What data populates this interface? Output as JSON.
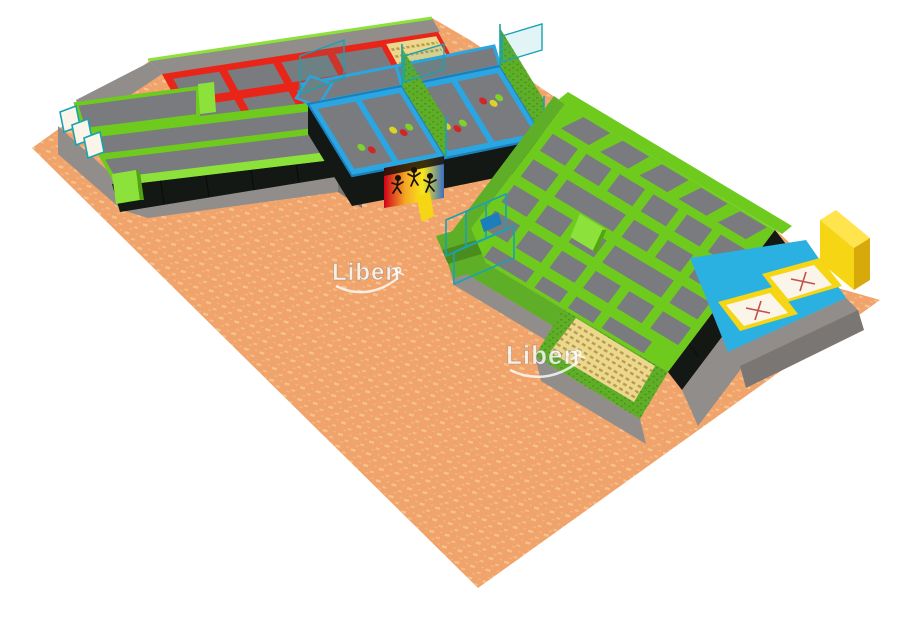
{
  "watermark": {
    "text": "Liben"
  },
  "scene": {
    "type": "3d-isometric-render",
    "subject": "indoor trampoline park layout",
    "floor": "orange speckled carpet",
    "zones": [
      "runway-lanes-left-wing",
      "angled-wall-trampoline",
      "red-trampoline-grid",
      "foam-block-pit-top",
      "dodgeball-court-1",
      "dodgeball-court-2",
      "grass-divider-walls",
      "graffiti-mural-panel",
      "slide",
      "basketball-hoop-frames",
      "grass-steps",
      "main-trampoline-court",
      "wedge-ramp",
      "foam-block-pit-bottom",
      "airbag-landing-zone"
    ]
  },
  "colors": {
    "bg": "#ffffff",
    "carpet": "#f0a36b",
    "carpet_speckle": "#f9d09a",
    "wall_gray": "#918d8a",
    "wall_gray_dark": "#7a7673",
    "wall_gray_light": "#a39f9b",
    "pad_black": "#141814",
    "pad_line": "#000000",
    "frame_green": "#6ecb1e",
    "frame_green_dark": "#51a511",
    "frame_green_light": "#8ce23a",
    "frame_red": "#e92519",
    "frame_blue": "#2aa6e2",
    "frame_blue_dark": "#1d7fba",
    "mat_gray": "#797b7e",
    "mat_gray_dark": "#626468",
    "grass": "#5fae28",
    "grass_dark": "#4a8d1d",
    "glass_teal": "#18a2b4",
    "foam_tan": "#ecd88c",
    "foam_tan_dark": "#b99c50",
    "yellow": "#f6d514",
    "yellow_dark": "#d8a90b",
    "yellow_light": "#ffe44d",
    "airbag_white": "#faf5e8",
    "cross_red": "#c25050",
    "floor_blue": "#2ab1e2",
    "ball_red": "#cf2727",
    "ball_yellow": "#ddd226",
    "ball_green": "#7ed32b",
    "mural_a": "#f8e71c",
    "mural_b": "#f5a623",
    "mural_c": "#d0021b",
    "mural_d": "#3a6fc4",
    "mural_dark": "#1a1208",
    "watermark_fill": "rgba(255,255,255,0.8)",
    "watermark_shadow": "rgba(110,100,95,0.5)"
  }
}
